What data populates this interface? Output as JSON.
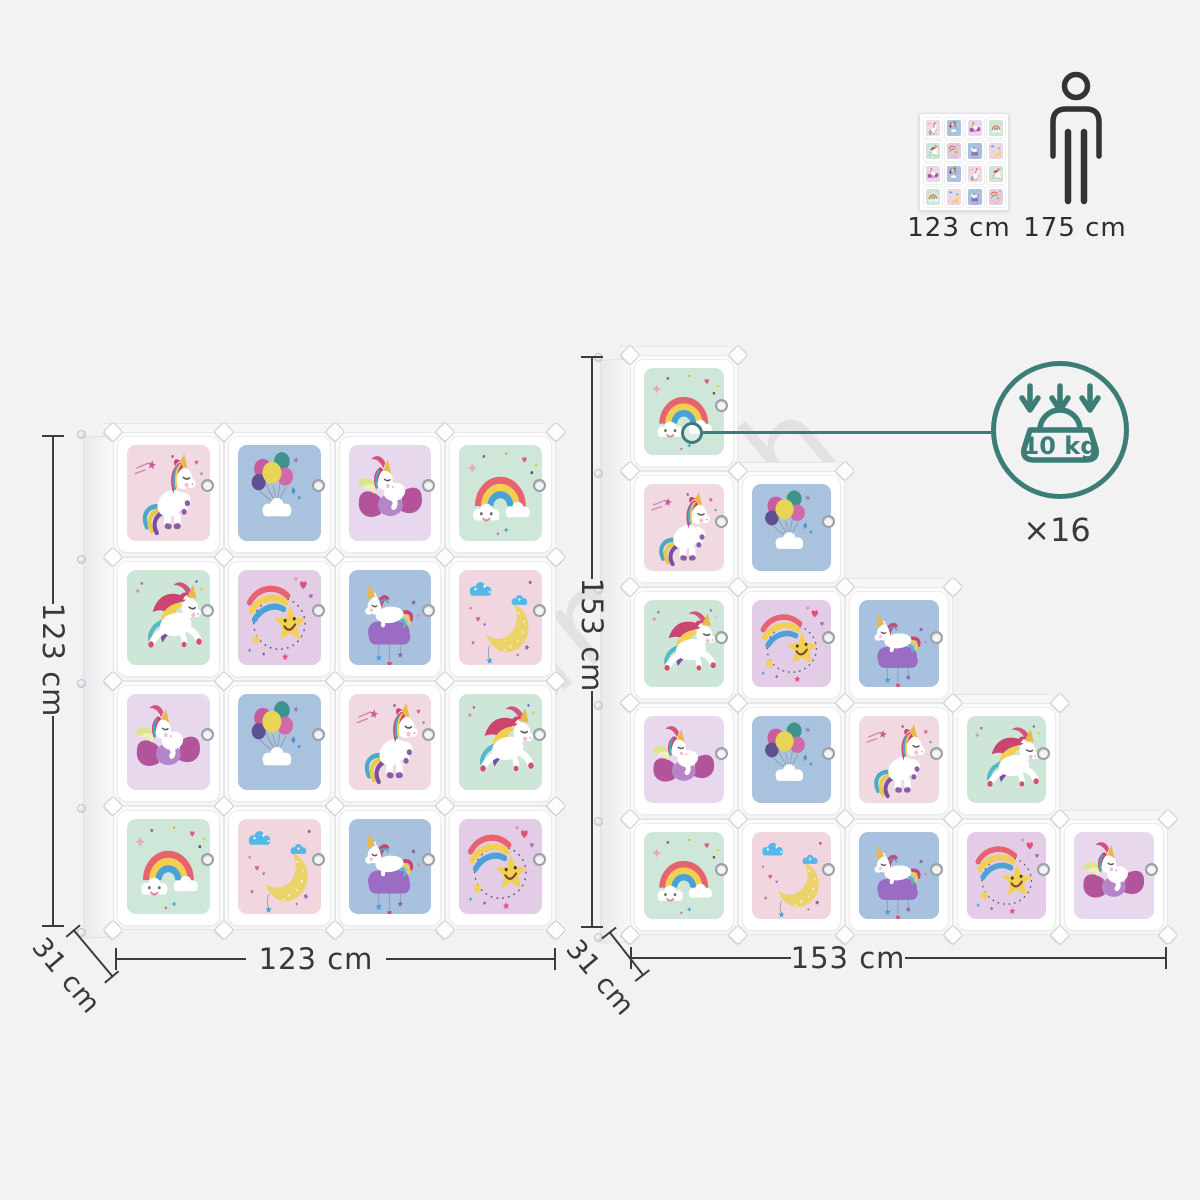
{
  "watermark": "alasans.ch",
  "reference": {
    "thumbnail_label": "123 cm",
    "person_label": "175 cm"
  },
  "load_badge": {
    "weight_label": "10 kg",
    "count_label": "×16",
    "accent_color": "#3c7d77"
  },
  "cabinets": {
    "left": {
      "height_label": "123 cm",
      "width_label": "123 cm",
      "depth_label": "31 cm",
      "rows": [
        [
          "unicorn-rearing",
          "balloons-cloud",
          "unicorn-on-bow",
          "rainbow-cloud"
        ],
        [
          "unicorn-galloping",
          "shooting-star",
          "unicorn-on-cloud",
          "moon-clouds"
        ],
        [
          "unicorn-on-bow",
          "balloons-cloud",
          "unicorn-rearing",
          "unicorn-galloping"
        ],
        [
          "rainbow-cloud",
          "moon-clouds",
          "unicorn-on-cloud",
          "shooting-star"
        ]
      ]
    },
    "right": {
      "height_label": "153 cm",
      "width_label": "153 cm",
      "depth_label": "31 cm",
      "rows": [
        [
          "rainbow-cloud"
        ],
        [
          "unicorn-rearing",
          "balloons-cloud"
        ],
        [
          "unicorn-galloping",
          "shooting-star",
          "unicorn-on-cloud"
        ],
        [
          "unicorn-on-bow",
          "balloons-cloud",
          "unicorn-rearing",
          "unicorn-galloping"
        ],
        [
          "rainbow-cloud",
          "moon-clouds",
          "unicorn-on-cloud",
          "shooting-star",
          "unicorn-on-bow"
        ]
      ]
    }
  },
  "motifs": {
    "rainbow-cloud": {
      "bg": "#cfe7d9",
      "icon": "rainbow-smiling-cloud-icon"
    },
    "balloons-cloud": {
      "bg": "#a9c2dd",
      "icon": "balloons-over-cloud-icon"
    },
    "unicorn-rearing": {
      "bg": "#f0d9e1",
      "icon": "rearing-unicorn-icon"
    },
    "unicorn-galloping": {
      "bg": "#cde6d8",
      "icon": "leaping-unicorn-icon"
    },
    "shooting-star": {
      "bg": "#e3cce6",
      "icon": "rainbow-shooting-star-icon"
    },
    "unicorn-on-cloud": {
      "bg": "#a7c1df",
      "icon": "unicorn-sleeping-on-cloud-icon"
    },
    "moon-clouds": {
      "bg": "#f2d6df",
      "icon": "crescent-moon-clouds-icon"
    },
    "unicorn-on-bow": {
      "bg": "#e7d8ee",
      "icon": "unicorn-on-candy-bow-icon"
    }
  },
  "colors": {
    "dimension": "#3c3c3e",
    "teal": "#3c7d77",
    "background": "#f2f2f3"
  }
}
